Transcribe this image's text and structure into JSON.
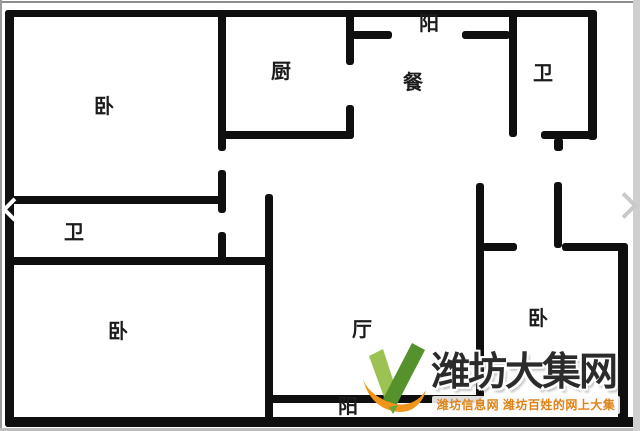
{
  "floorplan": {
    "wall_color": "#0f0f0f",
    "background_color": "#ffffff",
    "rooms": [
      {
        "id": "bedroom-top-left",
        "label": "卧",
        "cx": 104,
        "cy": 107
      },
      {
        "id": "kitchen",
        "label": "厨",
        "cx": 281,
        "cy": 72
      },
      {
        "id": "balcony-top",
        "label": "阳",
        "cx": 429,
        "cy": 24
      },
      {
        "id": "dining",
        "label": "餐",
        "cx": 413,
        "cy": 83
      },
      {
        "id": "bathroom-top-right",
        "label": "卫",
        "cx": 543,
        "cy": 74
      },
      {
        "id": "bathroom-left",
        "label": "卫",
        "cx": 74,
        "cy": 233
      },
      {
        "id": "bedroom-bottom-left",
        "label": "卧",
        "cx": 118,
        "cy": 332
      },
      {
        "id": "living-room",
        "label": "厅",
        "cx": 362,
        "cy": 330
      },
      {
        "id": "bedroom-bottom-right",
        "label": "卧",
        "cx": 538,
        "cy": 319
      },
      {
        "id": "balcony-bottom",
        "label": "阳",
        "cx": 348,
        "cy": 407
      }
    ],
    "walls": [
      {
        "id": "outer-top",
        "x": 5,
        "y": 10,
        "w": 592,
        "h": 7
      },
      {
        "id": "outer-left",
        "x": 5,
        "y": 10,
        "w": 9,
        "h": 417
      },
      {
        "id": "outer-bottom",
        "x": 5,
        "y": 417,
        "w": 635,
        "h": 10
      },
      {
        "id": "outer-right-upper",
        "x": 588,
        "y": 10,
        "w": 9,
        "h": 130
      },
      {
        "id": "outer-right-lower",
        "x": 618,
        "y": 243,
        "w": 10,
        "h": 180
      },
      {
        "id": "bed1-right-upper",
        "x": 218,
        "y": 14,
        "w": 8,
        "h": 137
      },
      {
        "id": "bed1-right-mid",
        "x": 218,
        "y": 170,
        "w": 8,
        "h": 43
      },
      {
        "id": "bed1-right-lower",
        "x": 218,
        "y": 232,
        "w": 8,
        "h": 30
      },
      {
        "id": "bed1-bottom",
        "x": 11,
        "y": 196,
        "w": 212,
        "h": 8
      },
      {
        "id": "bath-left-bottom",
        "x": 11,
        "y": 257,
        "w": 262,
        "h": 8
      },
      {
        "id": "kitchen-right-upper",
        "x": 346,
        "y": 14,
        "w": 8,
        "h": 51
      },
      {
        "id": "kitchen-right-lower",
        "x": 346,
        "y": 105,
        "w": 8,
        "h": 33
      },
      {
        "id": "kitchen-bottom",
        "x": 223,
        "y": 131,
        "w": 131,
        "h": 8
      },
      {
        "id": "balcony-top-wall-left",
        "x": 352,
        "y": 31,
        "w": 40,
        "h": 8
      },
      {
        "id": "balcony-top-wall-right",
        "x": 462,
        "y": 31,
        "w": 48,
        "h": 8
      },
      {
        "id": "dining-bath-divider",
        "x": 509,
        "y": 14,
        "w": 8,
        "h": 123
      },
      {
        "id": "bath-tr-bottom",
        "x": 541,
        "y": 131,
        "w": 56,
        "h": 8
      },
      {
        "id": "bath-tr-door-stub",
        "x": 554,
        "y": 138,
        "w": 9,
        "h": 13
      },
      {
        "id": "living-left",
        "x": 265,
        "y": 194,
        "w": 8,
        "h": 230
      },
      {
        "id": "living-right",
        "x": 476,
        "y": 183,
        "w": 8,
        "h": 216
      },
      {
        "id": "entry-divider",
        "x": 554,
        "y": 182,
        "w": 8,
        "h": 66
      },
      {
        "id": "bed3-top-wall-left",
        "x": 482,
        "y": 243,
        "w": 35,
        "h": 8
      },
      {
        "id": "bed3-top-wall-right",
        "x": 562,
        "y": 243,
        "w": 65,
        "h": 8
      },
      {
        "id": "balcony-bottom-wall",
        "x": 269,
        "y": 395,
        "w": 212,
        "h": 8
      }
    ]
  },
  "carousel": {
    "prev_icon": "chevron-left",
    "next_icon": "chevron-right"
  },
  "watermark": {
    "title": "潍坊大集网",
    "subtitle": "潍坊信息网 潍坊百姓的网上大集",
    "title_color": "#2b2b2b",
    "subtitle_color": "#e08214",
    "logo_green_light": "#9cc253",
    "logo_green_dark": "#55922c",
    "logo_orange": "#f0941c"
  }
}
